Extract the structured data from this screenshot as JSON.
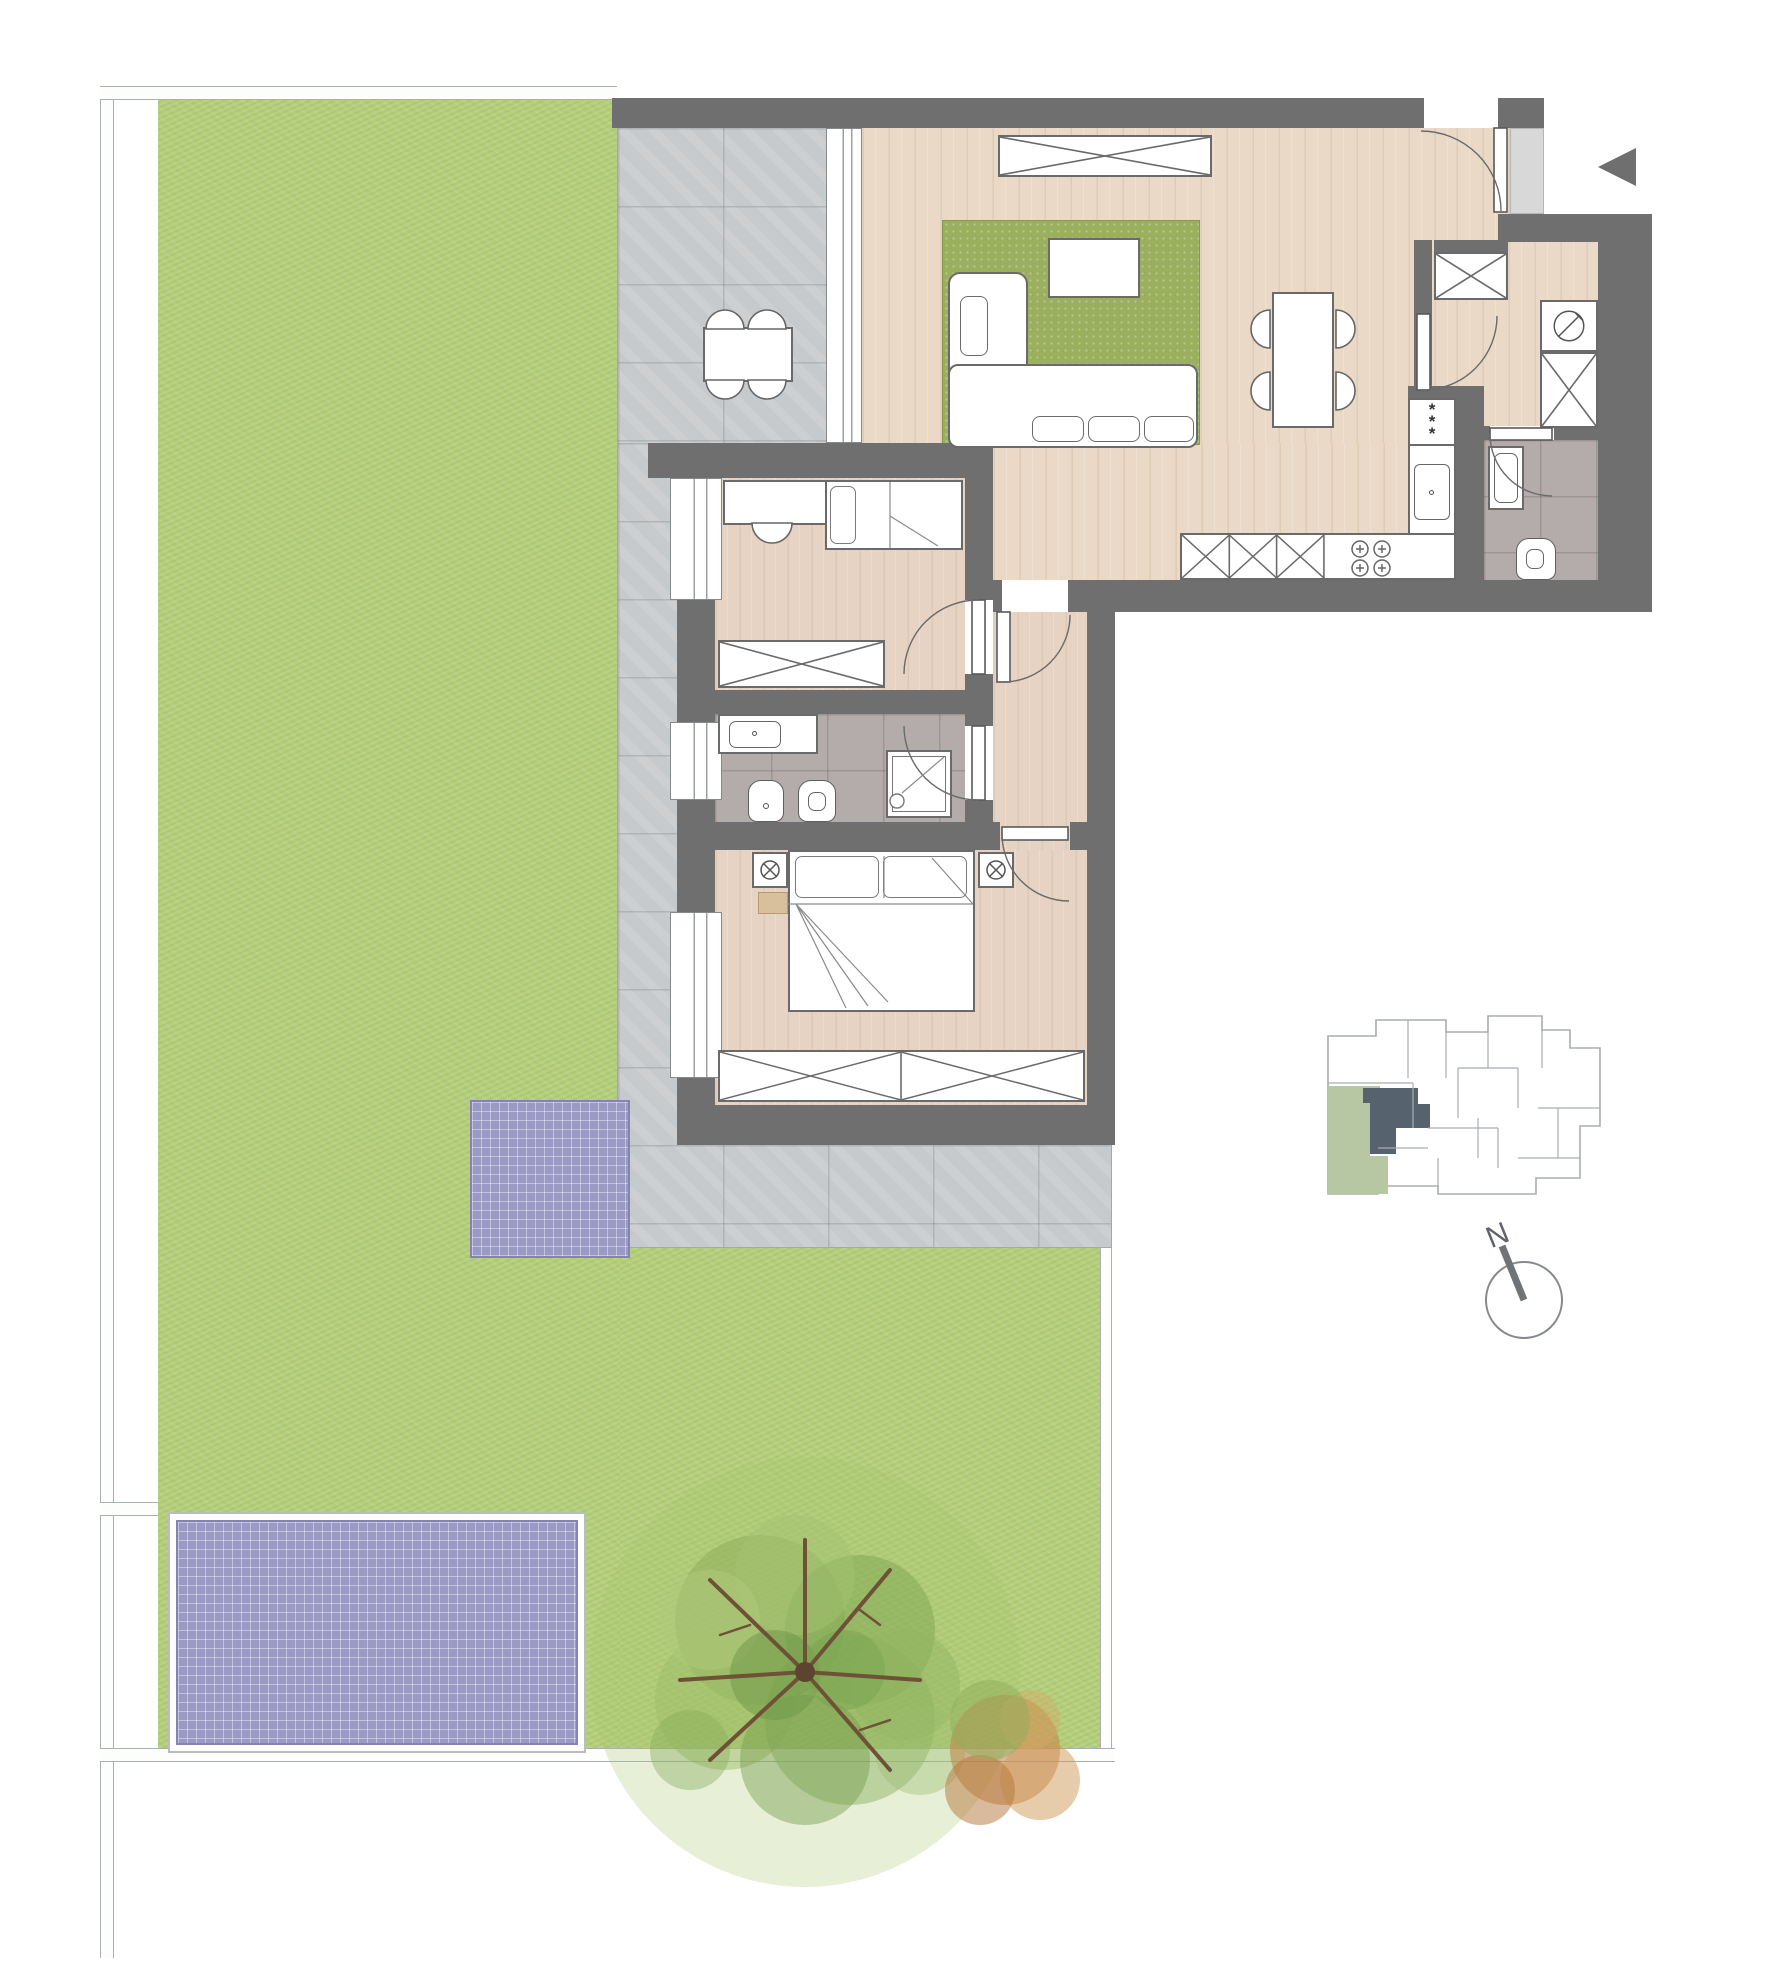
{
  "compass": {
    "label": "N"
  },
  "kitchen": {
    "appliance_marks": "*\n*\n*"
  },
  "palette": {
    "wall": "#6f6f6f",
    "wood": "#ead9c6",
    "wood_bedroom": "#e6d3c3",
    "terrace": "#c7cacc",
    "bath_tile": "#b4abab",
    "grass": "#b5cf7c",
    "rug": "#9ab05f",
    "panel": "#9b9ac5",
    "landing": "#d8d8d8",
    "keyplan_unit": "#57626f",
    "keyplan_garden": "#b7c7a3"
  },
  "symbols": {
    "entry_arrow": "left-pointing-triangle",
    "boiler": "circle-with-slash",
    "bedside_lamp": "circle-with-cross",
    "closet": "rectangle-with-diagonal-cross",
    "cooktop": "four-burner-circles"
  }
}
